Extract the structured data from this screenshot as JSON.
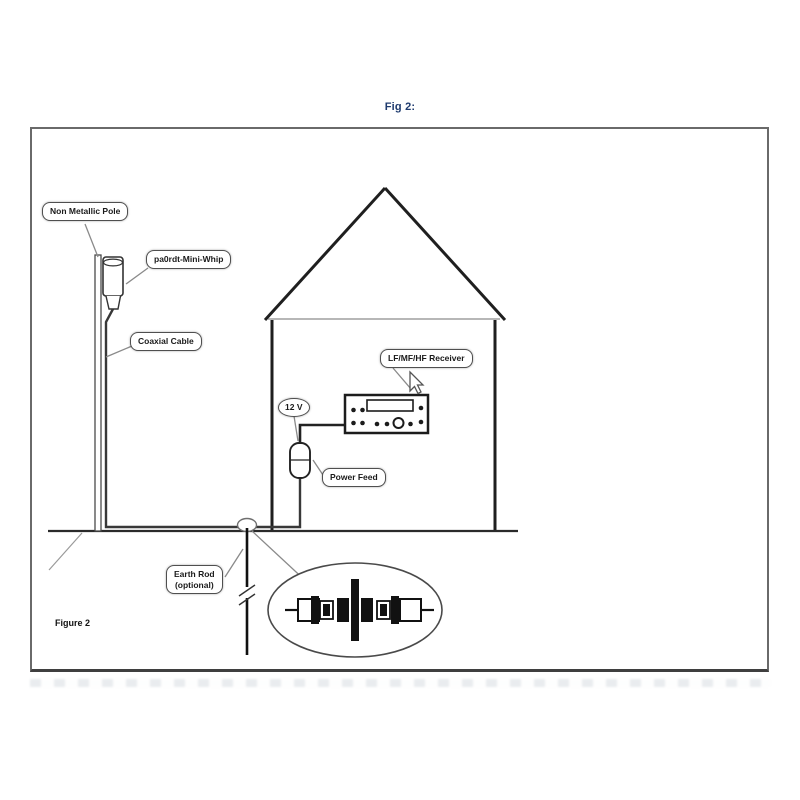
{
  "title": "Fig 2:",
  "figure_caption": "Figure 2",
  "labels": {
    "pole": "Non Metallic Pole",
    "antenna": "pa0rdt-Mini-Whip",
    "coax": "Coaxial Cable",
    "receiver": "LF/MF/HF Receiver",
    "voltage": "12 V",
    "power_feed": "Power Feed",
    "earth_rod_line1": "Earth Rod",
    "earth_rod_line2": "(optional)"
  },
  "colors": {
    "title_navy": "#1e3a6e",
    "line_dark": "#2e2e2e",
    "leader_gray": "#8a8a8a",
    "frame_gray": "#6a6a6a"
  },
  "icons": {
    "cursor": "mouse-cursor-icon"
  }
}
